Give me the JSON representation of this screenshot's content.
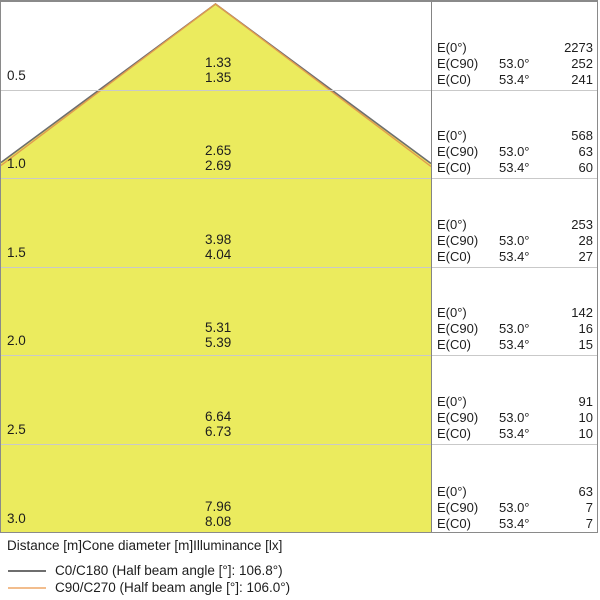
{
  "colors": {
    "cone_fill": "#ebeb5e",
    "c0_line": "#6e6e6e",
    "c90_line": "#e09a50",
    "grid_line": "#c9c9c9",
    "border": "#8a8a8a",
    "text": "#1d1d1d"
  },
  "labels": {
    "e0": "E(0°)",
    "ec90": "E(C90)",
    "ec0": "E(C0)"
  },
  "rows": [
    {
      "distance": "0.5",
      "diameter_c90": "1.33",
      "diameter_c0": "1.35",
      "e0": "2273",
      "angle_c90": "53.0°",
      "e_c90": "252",
      "angle_c0": "53.4°",
      "e_c0": "241"
    },
    {
      "distance": "1.0",
      "diameter_c90": "2.65",
      "diameter_c0": "2.69",
      "e0": "568",
      "angle_c90": "53.0°",
      "e_c90": "63",
      "angle_c0": "53.4°",
      "e_c0": "60"
    },
    {
      "distance": "1.5",
      "diameter_c90": "3.98",
      "diameter_c0": "4.04",
      "e0": "253",
      "angle_c90": "53.0°",
      "e_c90": "28",
      "angle_c0": "53.4°",
      "e_c0": "27"
    },
    {
      "distance": "2.0",
      "diameter_c90": "5.31",
      "diameter_c0": "5.39",
      "e0": "142",
      "angle_c90": "53.0°",
      "e_c90": "16",
      "angle_c0": "53.4°",
      "e_c0": "15"
    },
    {
      "distance": "2.5",
      "diameter_c90": "6.64",
      "diameter_c0": "6.73",
      "e0": "91",
      "angle_c90": "53.0°",
      "e_c90": "10",
      "angle_c0": "53.4°",
      "e_c0": "10"
    },
    {
      "distance": "3.0",
      "diameter_c90": "7.96",
      "diameter_c0": "8.08",
      "e0": "63",
      "angle_c90": "53.0°",
      "e_c90": "7",
      "angle_c0": "53.4°",
      "e_c0": "7"
    }
  ],
  "caption": "Distance [m]Cone diameter [m]Illuminance [lx]",
  "legend": [
    {
      "label": "C0/C180 (Half beam angle [°]: 106.8°)",
      "color": "#6e6e6e"
    },
    {
      "label": "C90/C270 (Half beam angle [°]: 106.0°)",
      "color": "#f2bd8d"
    }
  ],
  "chart_data": {
    "type": "table",
    "title": "Light cone diagram",
    "columns": [
      "Distance [m]",
      "Cone diameter C90/C270 [m]",
      "Cone diameter C0/C180 [m]",
      "E(0°) [lx]",
      "E(C90) angle",
      "E(C90) [lx]",
      "E(C0) angle",
      "E(C0) [lx]"
    ],
    "rows": [
      [
        0.5,
        1.33,
        1.35,
        2273,
        "53.0°",
        252,
        "53.4°",
        241
      ],
      [
        1.0,
        2.65,
        2.69,
        568,
        "53.0°",
        63,
        "53.4°",
        60
      ],
      [
        1.5,
        3.98,
        4.04,
        253,
        "53.0°",
        28,
        "53.4°",
        27
      ],
      [
        2.0,
        5.31,
        5.39,
        142,
        "53.0°",
        16,
        "53.4°",
        15
      ],
      [
        2.5,
        6.64,
        6.73,
        91,
        "53.0°",
        10,
        "53.4°",
        10
      ],
      [
        3.0,
        7.96,
        8.08,
        63,
        "53.0°",
        7,
        "53.4°",
        7
      ]
    ],
    "series_annotations": {
      "c0_c180_half_beam_angle": "106.8°",
      "c90_c270_half_beam_angle": "106.0°"
    }
  }
}
